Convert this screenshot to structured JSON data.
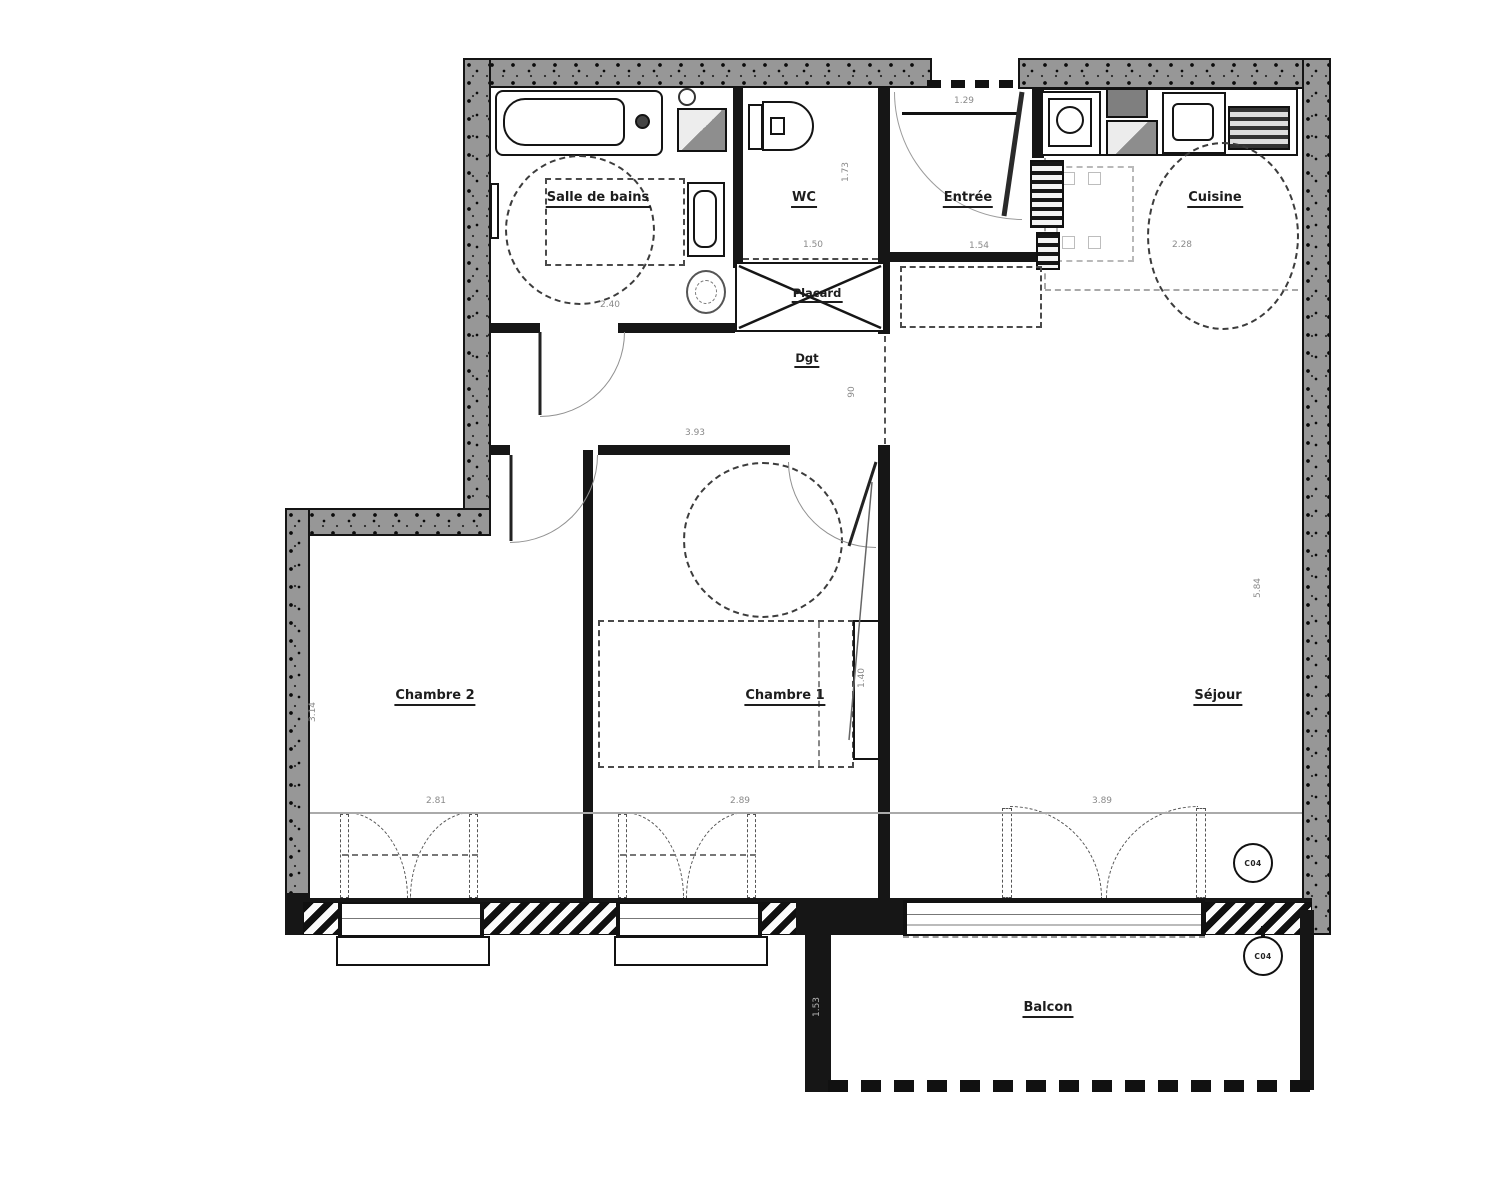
{
  "plan_type": "apartment-floor-plan",
  "rooms": {
    "salle_de_bains": "Salle de bains",
    "wc": "WC",
    "entree": "Entrée",
    "cuisine": "Cuisine",
    "placard": "Placard",
    "dgt": "Dgt",
    "chambre2": "Chambre 2",
    "chambre1": "Chambre 1",
    "sejour": "Séjour",
    "balcon": "Balcon"
  },
  "dimensions": {
    "entree_door_width": "1.29",
    "wc_depth": "1.73",
    "wc_width": "1.50",
    "entree_width": "1.54",
    "cuisine_width": "2.28",
    "sdb_width": "2.40",
    "dgt_width": "3.93",
    "dgt_passage": "90",
    "chambre2_width": "2.81",
    "chambre2_depth": "3.14",
    "chambre1_width": "2.89",
    "chambre1_bed": "1.40",
    "sejour_width": "3.89",
    "sejour_depth": "5.84",
    "balcon_depth": "1.53"
  },
  "tags": {
    "window_tag_top": "C04",
    "window_tag_bottom": "C04"
  }
}
